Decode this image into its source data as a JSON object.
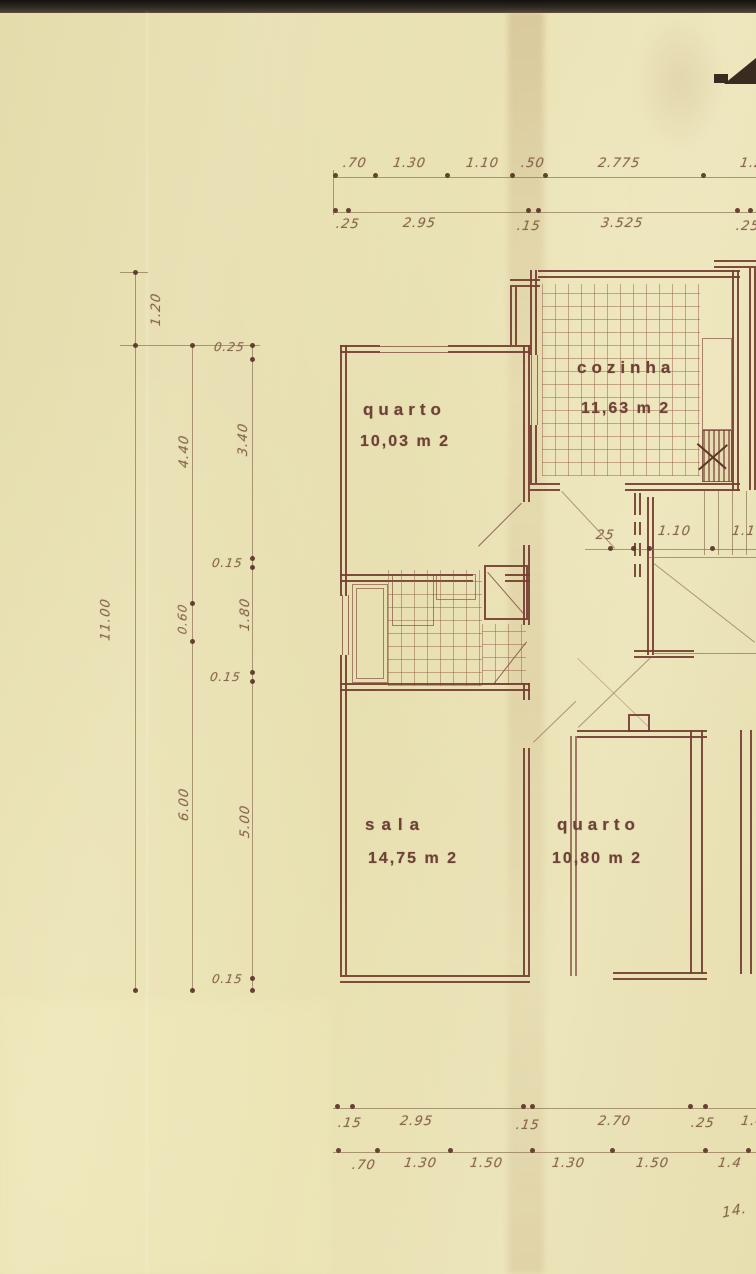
{
  "palette": {
    "paper": "#e7dfb2",
    "ink": "#743e32",
    "pencil": "#8c7352",
    "label_text": "#6d4136",
    "scan_strip": "#241f19"
  },
  "rooms": {
    "quarto1": {
      "name": "quarto",
      "area": "10,03 m 2"
    },
    "cozinha": {
      "name": "cozinha",
      "area": "11,63 m 2"
    },
    "sala": {
      "name": "sala",
      "area": "14,75 m 2"
    },
    "quarto2": {
      "name": "quarto",
      "area": "10,80 m 2"
    }
  },
  "dimensions": {
    "top_row1": [
      ".70",
      "1.30",
      "1.10",
      ".50",
      "2.775",
      "1.2"
    ],
    "top_row2": [
      ".25",
      "2.95",
      ".15",
      "3.525",
      ".25"
    ],
    "left_outer_top": "1.20",
    "left_outer_total": "11.00",
    "left_mid": [
      "4.40",
      "0.60",
      "6.00"
    ],
    "left_inner": [
      "0.25",
      "3.40",
      "0.15",
      "1.80",
      "0.15",
      "5.00",
      "0.15"
    ],
    "hall_row": [
      "25",
      "1.10",
      "1.1"
    ],
    "bottom_row1": [
      ".15",
      "2.95",
      ".15",
      "2.70",
      ".25",
      "1.4"
    ],
    "bottom_row2": [
      ".70",
      "1.30",
      "1.50",
      "1.30",
      "1.50",
      "1.4"
    ],
    "bottom_partial": "14."
  }
}
